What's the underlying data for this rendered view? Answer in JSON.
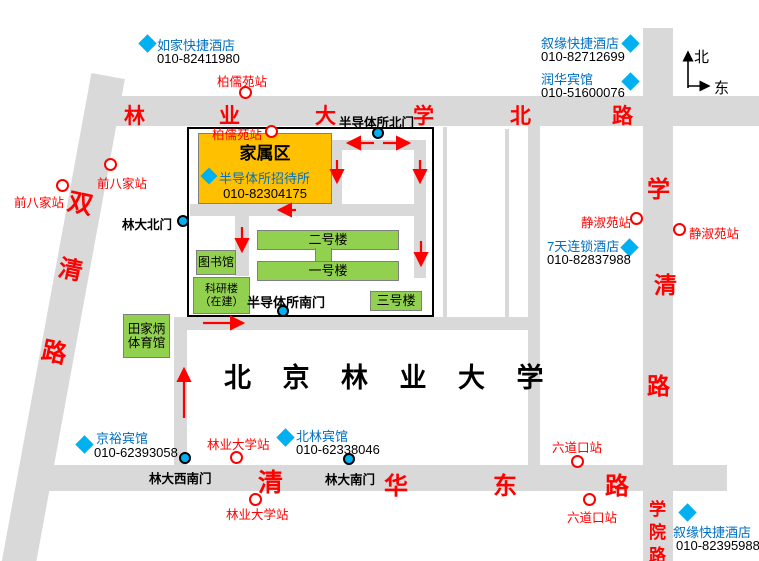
{
  "compass": {
    "north": "北",
    "east": "东"
  },
  "roads": {
    "north": {
      "chars": [
        "林",
        "业",
        "大",
        "学",
        "北",
        "路"
      ]
    },
    "shuangqing": {
      "chars": [
        "双",
        "清",
        "路"
      ]
    },
    "xueqing": {
      "chars": [
        "学",
        "清",
        "路"
      ]
    },
    "qinghua_east": {
      "chars": [
        "清",
        "华",
        "东",
        "路"
      ]
    },
    "xueyuan": {
      "chars": [
        "学",
        "院",
        "路"
      ]
    }
  },
  "campus": {
    "title": "北 京 林 业 大 学",
    "gym": {
      "line1": "田家炳",
      "line2": "体育馆"
    }
  },
  "compound": {
    "family_area": "家属区",
    "guesthouse": {
      "name": "半导体所招待所",
      "phone": "010-82304175"
    },
    "buildings": {
      "no2": "二号楼",
      "no1": "一号楼",
      "no3": "三号楼",
      "library": "图书馆",
      "research_line1": "科研楼",
      "research_line2": "（在建）"
    }
  },
  "gates": {
    "semi_north": "半导体所北门",
    "semi_south": "半导体所南门",
    "linda_north": "林大北门",
    "linda_southwest": "林大西南门",
    "linda_south": "林大南门"
  },
  "stations": {
    "bairuyuan_1": "柏儒苑站",
    "bairuyuan_2": "柏儒苑站",
    "qianbajia_1": "前八家站",
    "qianbajia_2": "前八家站",
    "jingshuyuan_1": "静淑苑站",
    "jingshuyuan_2": "静淑苑站",
    "liudaokou_1": "六道口站",
    "liudaokou_2": "六道口站",
    "linyedaxue_1": "林业大学站",
    "linyedaxue_2": "林业大学站"
  },
  "hotels": {
    "rujia": {
      "name": "如家快捷酒店",
      "phone": "010-82411980"
    },
    "xuyuan_north": {
      "name": "叙缘快捷酒店",
      "phone": "010-82712699"
    },
    "runhua": {
      "name": "润华宾馆",
      "phone": "010-51600076"
    },
    "qitian": {
      "name": "7天连锁酒店",
      "phone": "010-82837988"
    },
    "jingyu": {
      "name": "京裕宾馆",
      "phone": "010-62393058"
    },
    "beilin": {
      "name": "北林宾馆",
      "phone": "010-62338046"
    },
    "xuyuan_south": {
      "name": "叙缘快捷酒店",
      "phone": "010-82395988"
    }
  },
  "colors": {
    "road_gray": "#D9D9D9",
    "building_green": "#92D050",
    "family_orange": "#FFC000",
    "station_red": "#FF0000",
    "hotel_text_blue": "#0070C0",
    "marker_blue": "#00B0F0"
  }
}
